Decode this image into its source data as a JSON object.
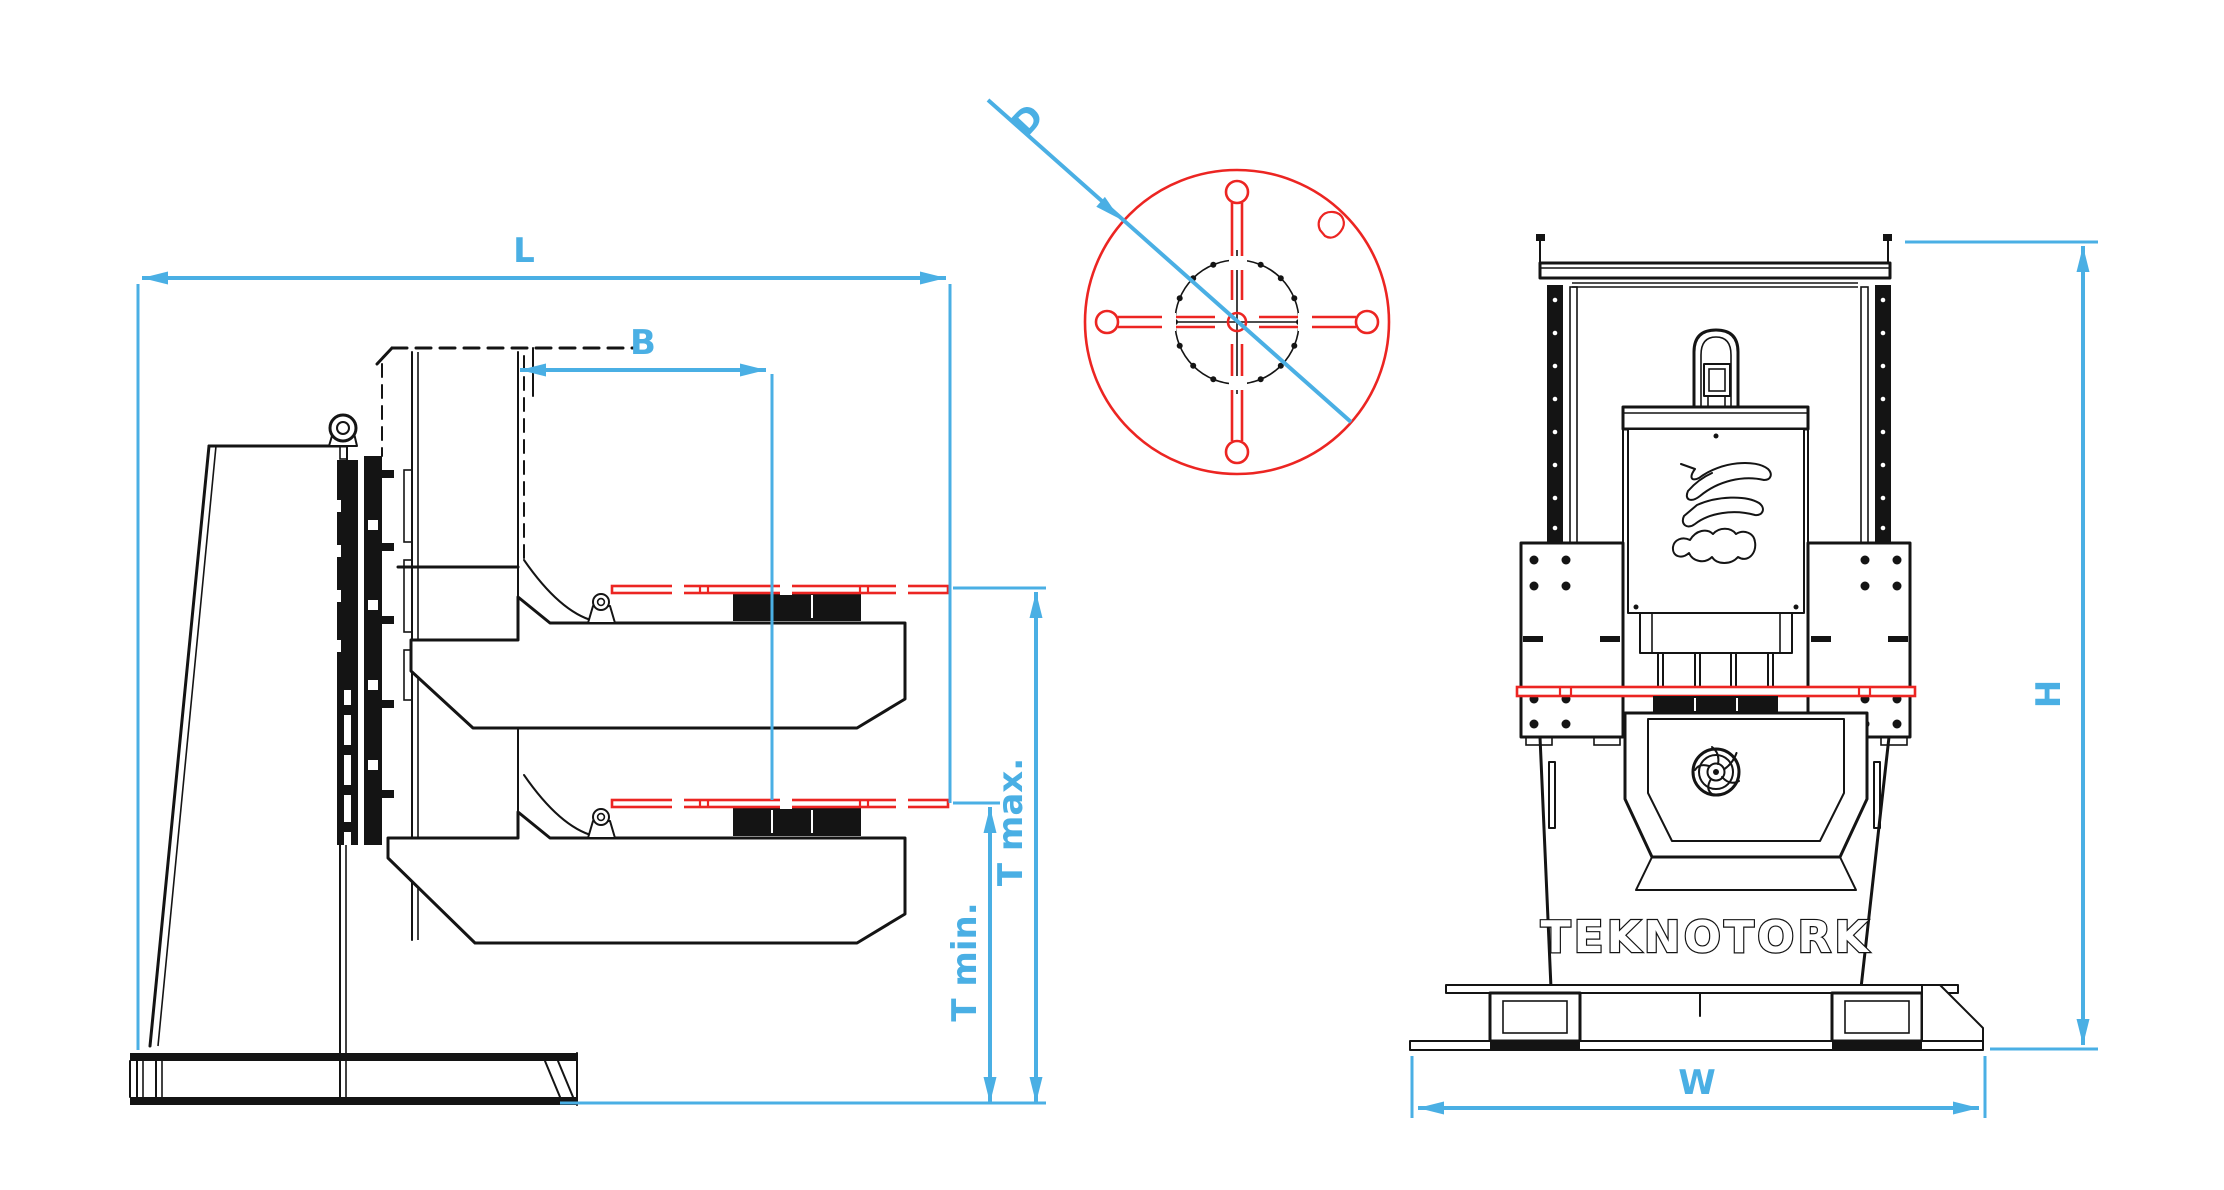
{
  "drawing": {
    "brand": "TEKNOTORK",
    "description": "Welding positioner technical drawing, three views",
    "views": {
      "side": {
        "name": "side-elevation",
        "dim_length_label": "L",
        "dim_boom_reach_label": "B",
        "dim_table_max_label": "T max.",
        "dim_table_min_label": "T min."
      },
      "faceplate": {
        "name": "faceplate-top-view",
        "dim_diameter_label": "D"
      },
      "front": {
        "name": "front-elevation",
        "dim_height_label": "H",
        "dim_width_label": "W",
        "brand_text": "TEKNOTORK"
      }
    },
    "colors": {
      "dim": "#4aafe4",
      "accent": "#ec2522",
      "ink": "#141414",
      "bg": "#ffffff"
    }
  }
}
